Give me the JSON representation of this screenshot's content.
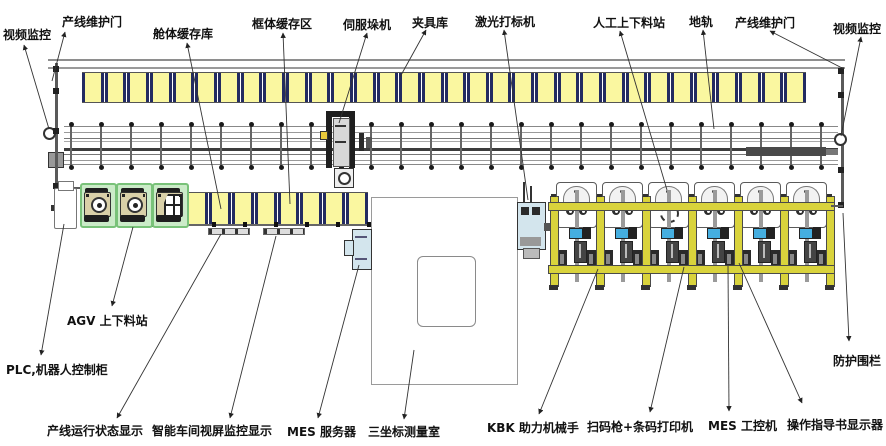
{
  "labels": {
    "video_monitor_left": "视频监控",
    "maintenance_door_left": "产线维护门",
    "cabin_buffer": "舱体缓存库",
    "frame_buffer": "框体缓存区",
    "servo_stacker": "伺服垛机",
    "fixture_library": "夹具库",
    "laser_marker": "激光打标机",
    "manual_station": "人工上下料站",
    "ground_rail": "地轨",
    "maintenance_door_right": "产线维护门",
    "video_monitor_right": "视频监控",
    "agv_station": "AGV 上下料站",
    "plc_cabinet": "PLC,机器人控制柜",
    "line_status_display": "产线运行状态显示",
    "workshop_monitor_display": "智能车间视屏监控显示",
    "mes_server": "MES 服务器",
    "cmm_room": "三坐标测量室",
    "kbk_manipulator": "KBK 助力机械手",
    "barcode_scanner_printer": "扫码枪+条码打印机",
    "mes_ipc": "MES 工控机",
    "instruction_display": "操作指导书显示器",
    "protective_fence": "防护围栏"
  },
  "equipment": {
    "fixture_buffer_cells": 32,
    "cabin_buffer_cells": 8,
    "workstation_count": 6,
    "agv_unit_count": 3,
    "rail_tie_count": 26
  },
  "colors": {
    "buffer_yellow": "#FAF7A0",
    "buffer_separator_navy": "#232B61",
    "kbk_frame_yellow": "#D9D33C",
    "agv_green_bg": "#CBEBC8",
    "agv_green_border": "#79C279",
    "machine_light_blue": "#D3E5ED",
    "display_blue": "#45AEE0",
    "rail_dark_bar": "#4A4A4A"
  }
}
